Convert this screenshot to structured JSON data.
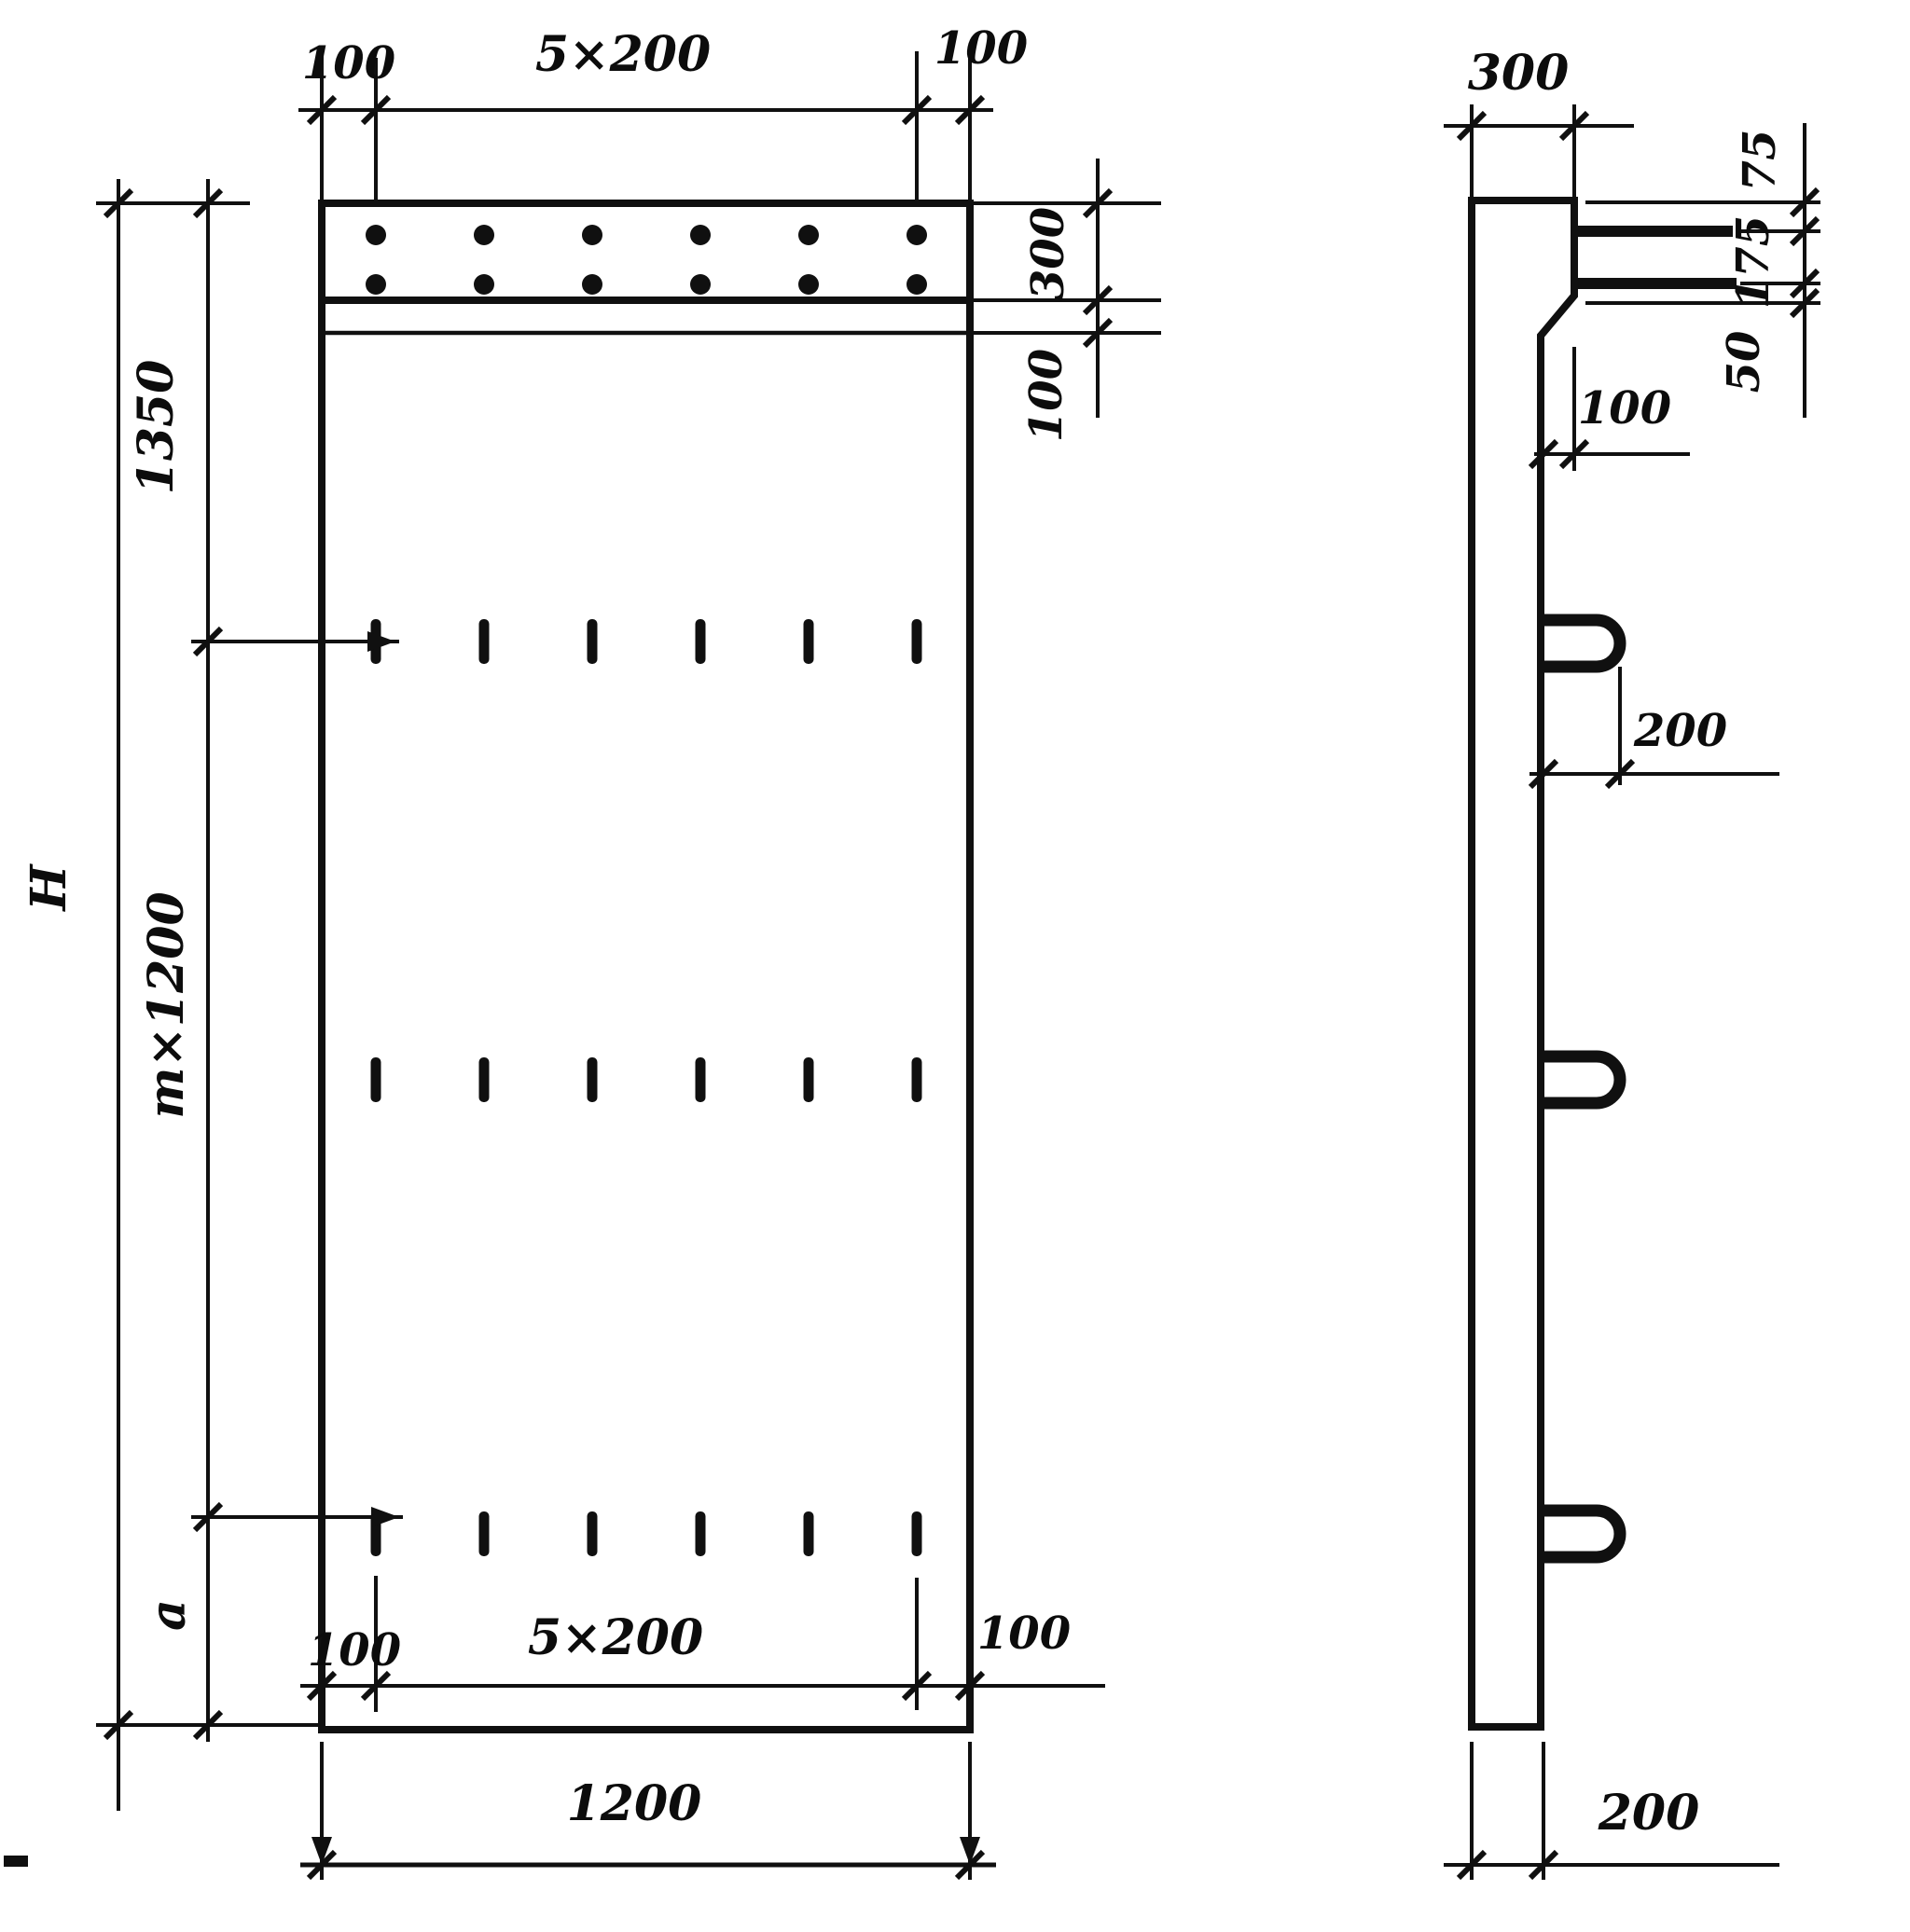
{
  "drawing": {
    "type": "technical-drawing",
    "description": "Reinforced concrete wall panel — front elevation (left) and side section (right) with dimension chains",
    "front": {
      "top_dims": {
        "left": "100",
        "middle": "5×200",
        "right": "100"
      },
      "right_dims": {
        "band": "300",
        "strip": "100"
      },
      "left_dims": {
        "top": "1350",
        "middle": "m×1200",
        "bottom": "a",
        "overall": "H"
      },
      "inner_bottom_dims": {
        "left": "100",
        "middle": "5×200",
        "right": "100"
      },
      "bottom_dim": {
        "width": "1200"
      },
      "dot_grid": {
        "rows": 2,
        "cols": 6
      },
      "loop_mark_grid": {
        "rows": 3,
        "cols": 6
      }
    },
    "side": {
      "top_dim": "300",
      "right_dims": {
        "top": "75",
        "middle": "175",
        "bottom": "50"
      },
      "ledge_dim": "100",
      "loop_dim": "200",
      "bottom_dim": "200",
      "bars": 2,
      "loops": 3
    }
  }
}
